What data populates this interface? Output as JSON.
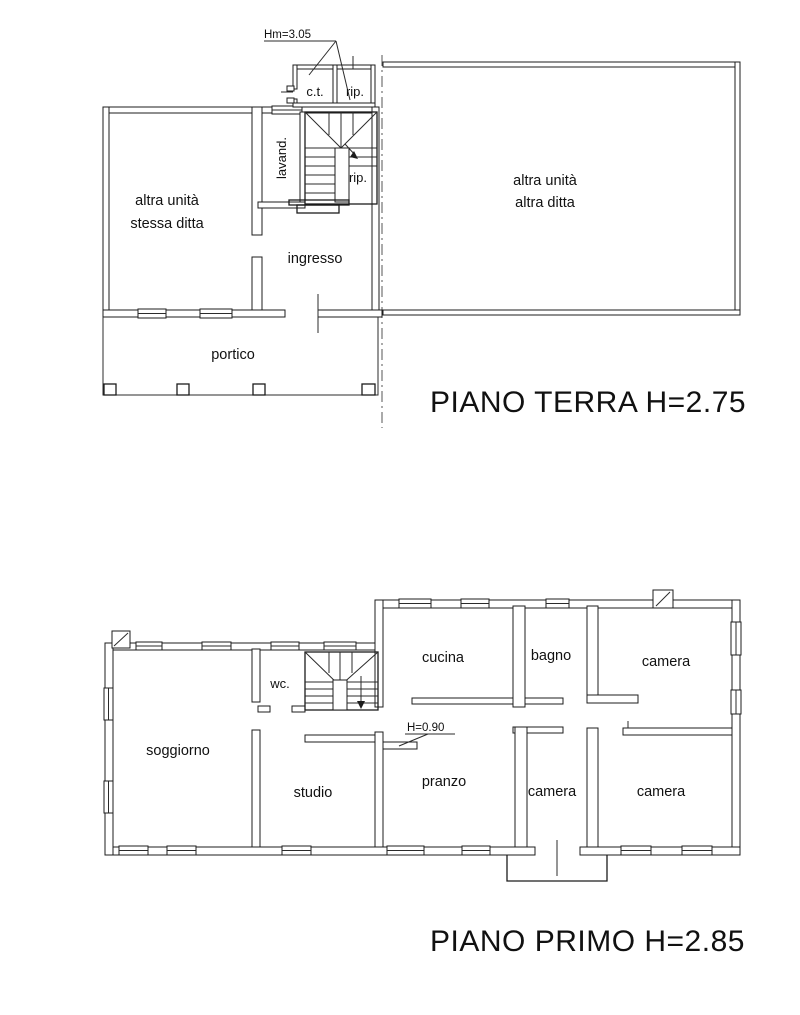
{
  "page": {
    "background": "#ffffff",
    "line_color": "#1c1c1c"
  },
  "ground_floor": {
    "title": "PIANO TERRA H=2.75",
    "height_note": "Hm=3.05",
    "rooms": {
      "ct": "c.t.",
      "rip_top": "rip.",
      "lavand": "lavand.",
      "rip_stairs": "rip.",
      "unit_left_1": "altra unità",
      "unit_left_2": "stessa ditta",
      "ingresso": "ingresso",
      "portico": "portico",
      "unit_right_1": "altra unità",
      "unit_right_2": "altra ditta"
    }
  },
  "first_floor": {
    "title": "PIANO PRIMO H=2.85",
    "height_note": "H=0.90",
    "rooms": {
      "soggiorno": "soggiorno",
      "wc": "wc.",
      "studio": "studio",
      "cucina": "cucina",
      "bagno": "bagno",
      "camera_top": "camera",
      "pranzo": "pranzo",
      "camera_mid": "camera",
      "camera_right": "camera"
    }
  }
}
